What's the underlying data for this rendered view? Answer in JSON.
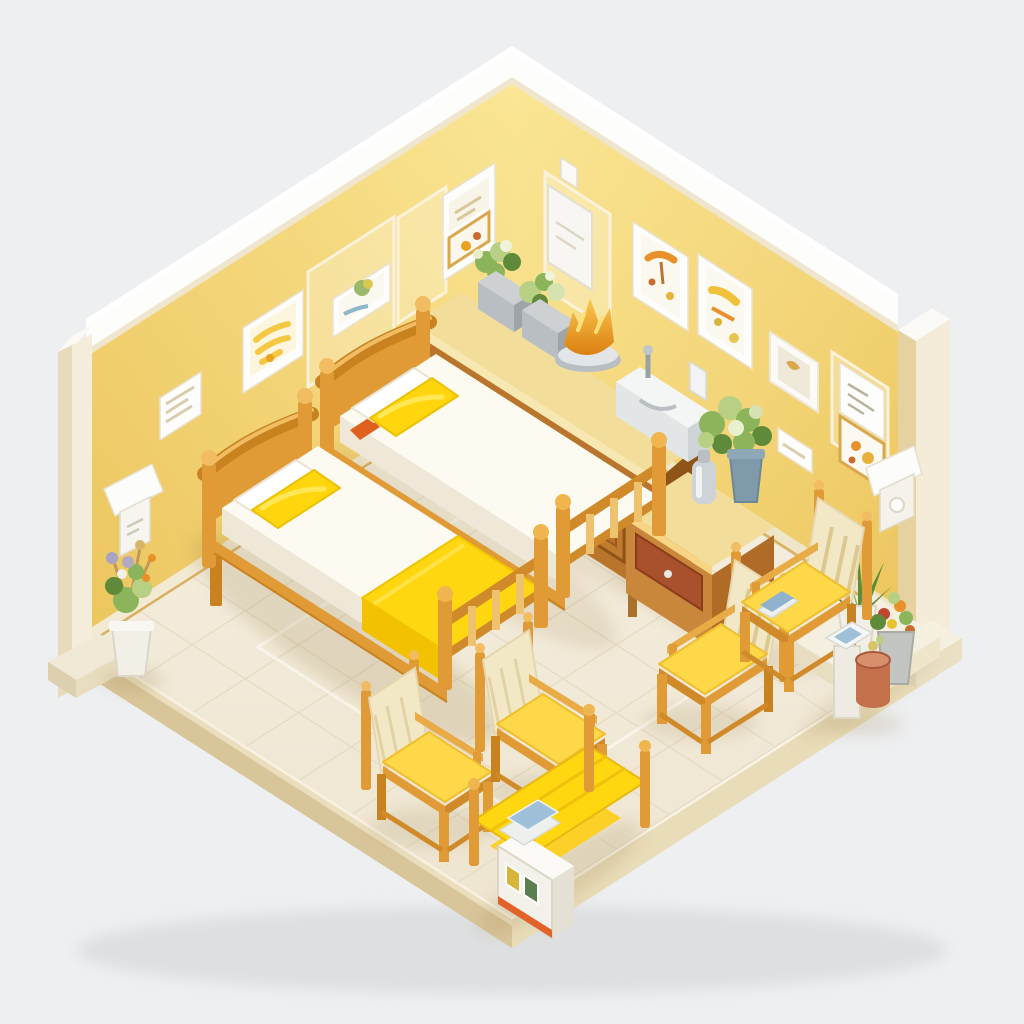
{
  "image": {
    "type": "3D isometric diorama illustration",
    "subject": "Miniature shared bedroom and sitting room rendered in warm yellow, cream and wood tones on a light grey background",
    "background_color": "#edeff0"
  },
  "palette": {
    "bg": "#edeff0",
    "wall": "#f4d67a",
    "wall_light": "#fae695",
    "wall_shade": "#ecc65e",
    "trim_white": "#fdfdfb",
    "trim_cream": "#efe6cd",
    "floor": "#f6f0e2",
    "floor_line": "#e4dac4",
    "platform_side": "#d9c59a",
    "platform_side_light": "#e9dcb8",
    "wood": "#e09b36",
    "wood_dark": "#c8821f",
    "wood_light": "#f2bd62",
    "cabinet": "#b9752c",
    "cabinet_dark": "#8f5518",
    "counter": "#f2dd9b",
    "mattress": "#fdfaf1",
    "pillow_yellow": "#ffd60d",
    "blanket": "#ffd711",
    "cushion": "#ffd84a",
    "back_cream": "#f3e8c6",
    "pot_gray": "#b9bec2",
    "pot_white": "#f1efe6",
    "pot_blue": "#7f9aab",
    "leaf": "#8cb45a",
    "leaf_dark": "#5f8a3a",
    "leaf_light": "#b8d084",
    "flower_orange": "#e8912b",
    "flower_red": "#c0452e",
    "terracotta": "#c4714b",
    "metal": "#cdd3d6"
  },
  "room": {
    "walls": {
      "left": "yellow panelled wall with picture frames, small white sign and pyramid sconce lamp",
      "right": "yellow panelled wall with picture frames, white dispenser box, wall niche and box sconce lamp",
      "trim": "white crown cap along both wall tops, cream corner post at left end and cream pillar at right end"
    },
    "floor": {
      "description": "cream tiled floor on a raised plinth with tan side faces and faint white inset border",
      "tile_grid": true
    }
  },
  "furniture": [
    {
      "name": "bed-back",
      "description": "wooden single bed, white mattress, white and yellow pillows, orange folded cloth near headboard"
    },
    {
      "name": "bed-front",
      "description": "wooden single bed, white mattress, white and yellow pillows, yellow blanket folded over the foot"
    },
    {
      "name": "sideboard",
      "description": "long wooden console on right wall with open book shelf, two panelled doors and cream counter top"
    },
    {
      "name": "nightstand",
      "description": "wooden side table with red-brown drawer, blue potted plant and metal carafe on top"
    },
    {
      "name": "armchair-left",
      "description": "wooden armchair, cream padded back, yellow seat cushion, facing right"
    },
    {
      "name": "armchair-mid",
      "description": "wooden armchair, cream padded back, yellow seat cushion, facing right"
    },
    {
      "name": "armchair-right-near",
      "description": "wooden slat-back chair with yellow seat, facing left"
    },
    {
      "name": "armchair-right-far",
      "description": "wooden slat-back chair with yellow seat and a small blue book, facing left"
    },
    {
      "name": "magazine-bench",
      "description": "yellow two-tier slatted bench with ball-top corner posts"
    },
    {
      "name": "magazine-rack",
      "description": "white magazine rack with orange base, colourful covers and stacked books on top"
    },
    {
      "name": "pedestal-stand",
      "description": "white pedestal stand with a blue tablet on top"
    },
    {
      "name": "waste-bin",
      "description": "terracotta cylindrical bin"
    }
  ],
  "decor": [
    {
      "name": "left-wall-art",
      "items": [
        "white frame with yellow artwork",
        "white frame with green and yellow painting",
        "double frame with sketch and gold print",
        "small white sign"
      ]
    },
    {
      "name": "right-wall-art",
      "items": [
        "white dispenser box with top tab",
        "white frame with orange umbrella print",
        "white frame with yellow-orange abstract print",
        "small landscape frame",
        "white wall niche with gold trinket",
        "small print with grey marks",
        "gold frame with orange print"
      ]
    },
    {
      "name": "sconces",
      "items": [
        "white pyramid sconce on left wall",
        "white box sconce beside right pillar"
      ]
    },
    {
      "name": "plants",
      "items": [
        "dry bouquet in white floor pot at left corner",
        "two grey planters on sideboard",
        "amber glass flower centerpiece on grey dish",
        "variegated plant in blue pot on nightstand",
        "spiky plant in white pot on right step",
        "flower arrangement in grey pot on right step"
      ]
    }
  ]
}
